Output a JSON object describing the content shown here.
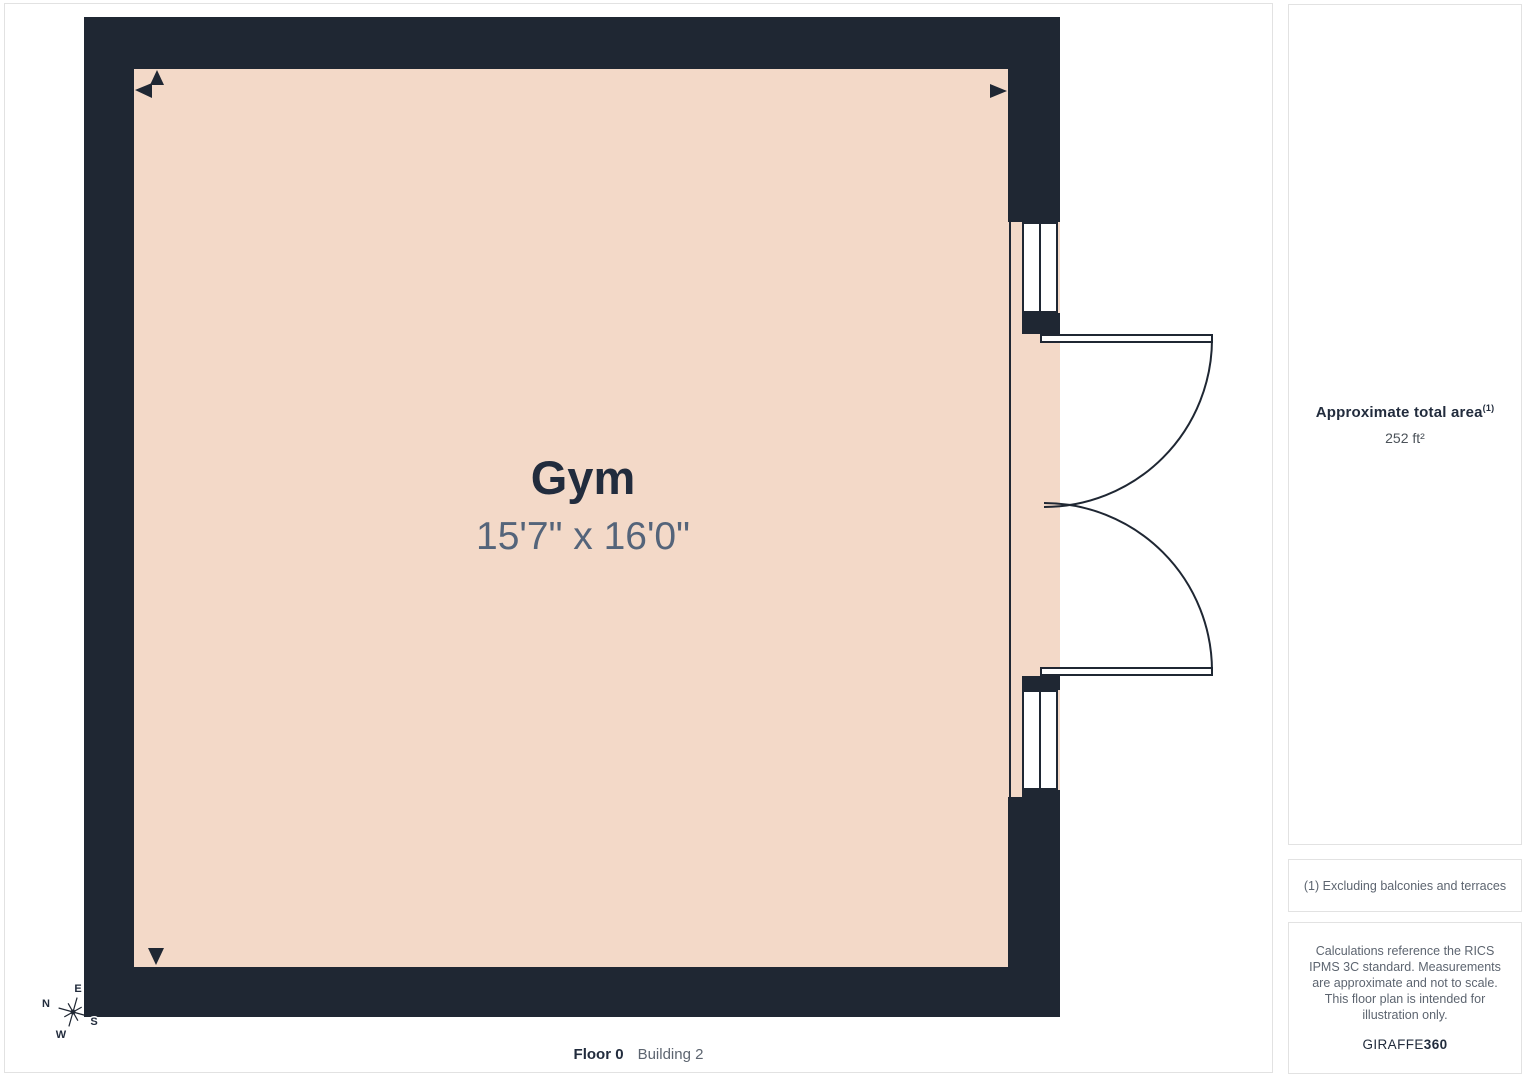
{
  "room": {
    "name": "Gym",
    "dimensions": "15'7\" x 16'0\""
  },
  "footer": {
    "floor": "Floor 0",
    "building": "Building 2"
  },
  "compass": {
    "north": "N",
    "east": "E",
    "south": "S",
    "west": "W"
  },
  "sidebar": {
    "area": {
      "heading": "Approximate total area",
      "footnote_ref": "(1)",
      "value": "252 ft²"
    },
    "footnote": "(1) Excluding balconies and terraces",
    "disclaimer": "Calculations reference the RICS IPMS 3C standard. Measurements are approximate and not to scale. This floor plan is intended for illustration only.",
    "brand": {
      "name": "GIRAFFE",
      "suffix": "360"
    }
  },
  "colors": {
    "wall": "#1f2733",
    "room": "#f3d9c8",
    "dim_text": "#54647a",
    "text_dark": "#222c3d",
    "text_gray": "#5d6570",
    "border": "#e2e2e2"
  }
}
